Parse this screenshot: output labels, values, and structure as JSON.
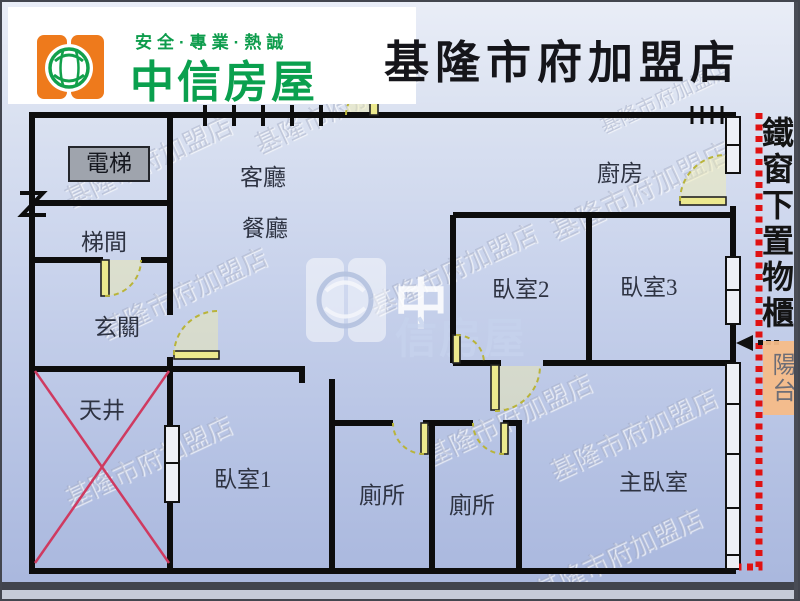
{
  "header": {
    "slogan": "安全·專業·熱誠",
    "brand": "中信房屋",
    "store_name": "基隆市府加盟店"
  },
  "floorplan": {
    "rooms": {
      "elevator": "電梯",
      "stairwell": "梯間",
      "entry": "玄關",
      "light_well": "天井",
      "living_room": "客廳",
      "dining_room": "餐廳",
      "kitchen": "廚房",
      "bedroom1": "臥室1",
      "bedroom2": "臥室2",
      "bedroom3": "臥室3",
      "toilet_a": "廁所",
      "toilet_b": "廁所",
      "master_bedroom": "主臥室",
      "balcony": "陽台"
    },
    "notes": {
      "iron_window": "鐵窗下置物櫃"
    }
  },
  "watermark": {
    "store_text": "基隆市府加盟店",
    "brand_char": "中",
    "brand_rest": "信房屋"
  },
  "colors": {
    "brand_green": "#0aa04e",
    "logo_orange": "#ee7a1c",
    "wall_black": "#0d0d0d",
    "door_yellow": "#ece98e",
    "red_dash": "#e01212",
    "x_mark": "#cf3a60",
    "balcony_bg": "#f6bc88"
  }
}
